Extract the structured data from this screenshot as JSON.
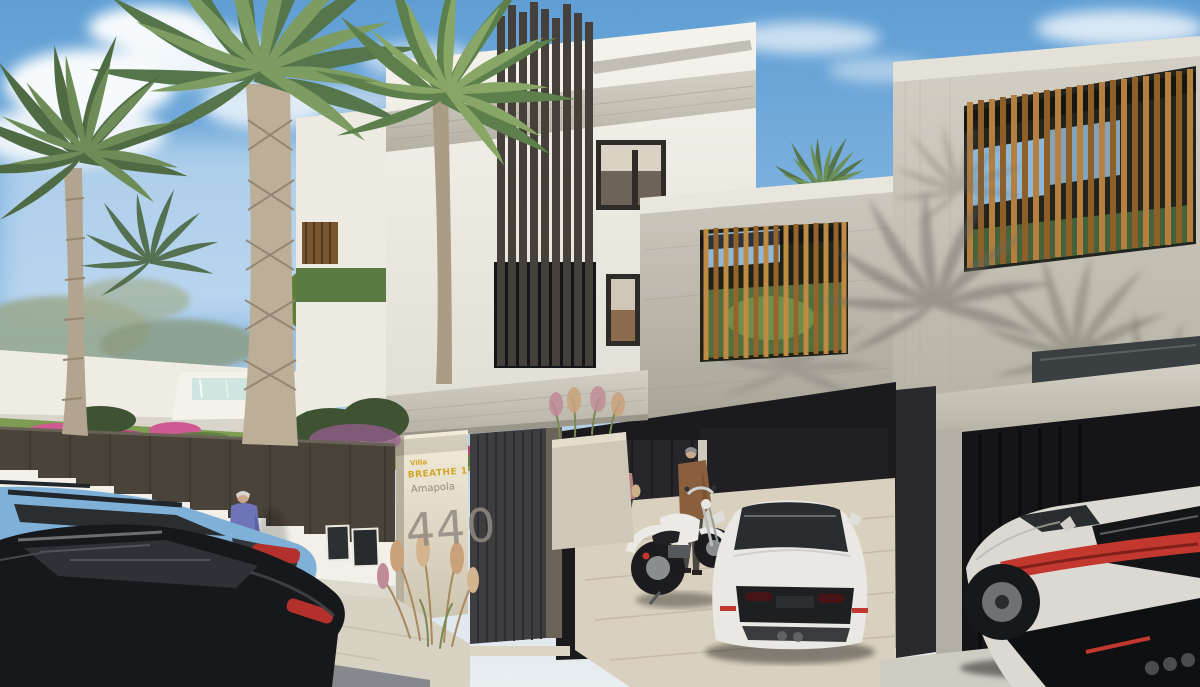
{
  "scene": {
    "type": "architectural-exterior-render",
    "description": "Daytime 3D rendering of a modern white villa street front: dark bronze vertical louvers, concrete carport with wood-slat screens, address sign 440, white Porsche coupe and white motorcycle in the carport, neighbouring concrete house with timber slat facade sheltering a white supercar, palm garden behind a stepped white wall, blue and black wagons parked on the street, three people.",
    "sign": {
      "line1": "Villa",
      "line2": "BREATHE 1",
      "line3": "Amapola",
      "number": "440"
    },
    "palette": {
      "sky": "#6aa6da",
      "cloud": "#f7fafc",
      "wall_white": "#f2f0e9",
      "concrete": "#c3bfb4",
      "concrete_shadow": "#a19d91",
      "louver_dark": "#46403a",
      "wood": "#b5803f",
      "lawn": "#7e9c52",
      "foliage": "#5f7f4a",
      "flower_pink": "#cf5a93",
      "street": "#85888c",
      "sidewalk": "#d8d2c4",
      "travertine": "#d9d0be",
      "car_blue": "#7fb0d8",
      "car_black": "#17181b",
      "car_white": "#e9e8e4",
      "tail_red": "#c2372e",
      "gate_dark": "#3e3e41",
      "sign_yellow": "#d2a62a",
      "sign_gray": "#8f8a81"
    },
    "objects": [
      "sky",
      "clouds",
      "palm-trees",
      "garden-lawn",
      "flower-beds",
      "water-feature",
      "orange-tree",
      "white-villa",
      "louver-screen",
      "concrete-band",
      "wood-slat-screen",
      "carport-beam",
      "entrance-gate",
      "address-sign",
      "planter-grasses",
      "utility-panels",
      "perimeter-wall",
      "garden-fence",
      "sidewalk",
      "street",
      "blue-wagon",
      "black-wagon",
      "pedestrian",
      "carport-woman",
      "carport-man",
      "white-motorcycle",
      "white-porsche-coupe",
      "neighbor-house",
      "timber-slat-facade",
      "white-supercar"
    ]
  }
}
